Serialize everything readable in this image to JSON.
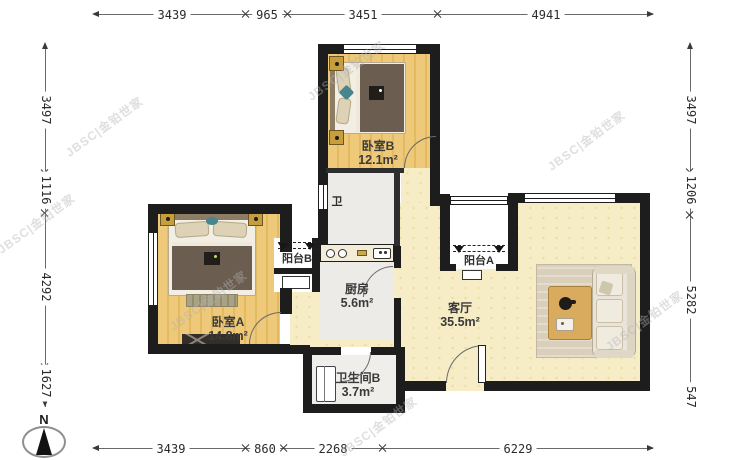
{
  "compass": {
    "label": "N"
  },
  "watermark": {
    "text": "JBSC|金铂世家"
  },
  "rooms": {
    "bedroom_a": {
      "name": "卧室A",
      "area": "14.8m²"
    },
    "bedroom_b": {
      "name": "卧室B",
      "area": "12.1m²"
    },
    "kitchen": {
      "name": "厨房",
      "area": "5.6m²"
    },
    "living_room": {
      "name": "客厅",
      "area": "35.5m²"
    },
    "bathroom_b": {
      "name": "卫生间B",
      "area": "3.7m²"
    },
    "bathroom_a": {
      "name": "卫"
    },
    "balcony_a": {
      "name": "阳台A"
    },
    "balcony_b": {
      "name": "阳台B"
    }
  },
  "dimensions": {
    "top": [
      "3439",
      "965",
      "3451",
      "4941"
    ],
    "bottom": [
      "3439",
      "860",
      "2268",
      "6229"
    ],
    "left": [
      "3497",
      "1116",
      "4292",
      "1627"
    ],
    "right": [
      "3497",
      "1206",
      "5282",
      "547"
    ]
  },
  "colors": {
    "wall": "#1d1d1d",
    "wood_floor": "#edc979",
    "living_floor": "#f6ecc5",
    "tile_floor": "#ecebe8",
    "accent_gold": "#c79e3c"
  }
}
